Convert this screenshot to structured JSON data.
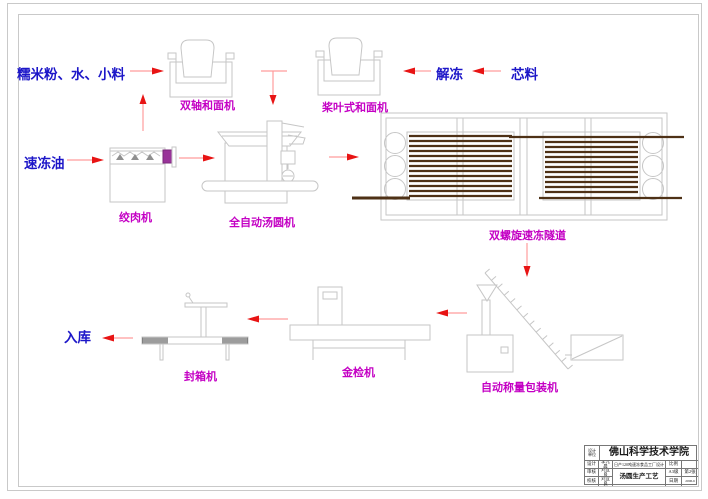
{
  "colors": {
    "outline_gray": "#c6c6c6",
    "blue_text": "#1c16c8",
    "magenta_label": "#c400c4",
    "arrow_red": "#e81414",
    "belt_brown": "#4e3116",
    "nozzle_purple": "#993399"
  },
  "flow": {
    "ingredients": "糯米粉、水、小料",
    "frozen_oil": "速冻油",
    "thaw": "解冻",
    "filling": "芯料",
    "warehouse": "入库"
  },
  "machines": {
    "double_shaft_mixer": "双轴和面机",
    "paddle_mixer": "桨叶式和面机",
    "meat_grinder": "绞肉机",
    "tangyuan_machine": "全自动汤圆机",
    "spiral_freezer": "双螺旋速冻隧道",
    "weigh_packer": "自动称量包装机",
    "metal_detector": "金检机",
    "box_sealer": "封箱机"
  },
  "title_block": {
    "org_label_line1": "设计",
    "org_label_line2": "单位",
    "org": "佛山科学技术学院",
    "row_design_label": "设计",
    "row_design_name": "李元晨",
    "row_check_label": "审核",
    "row_check_name": "刘宜良",
    "row_proof_label": "校核",
    "row_proof_name": "刘宜良",
    "project": "日产120吨速冻食品工厂设计",
    "drawing_title": "汤圆生产工艺",
    "scale_label": "比例",
    "sheet_size": "A3级",
    "sheet_no": "第2张",
    "date_label": "日期",
    "date_value": "2006.6"
  }
}
